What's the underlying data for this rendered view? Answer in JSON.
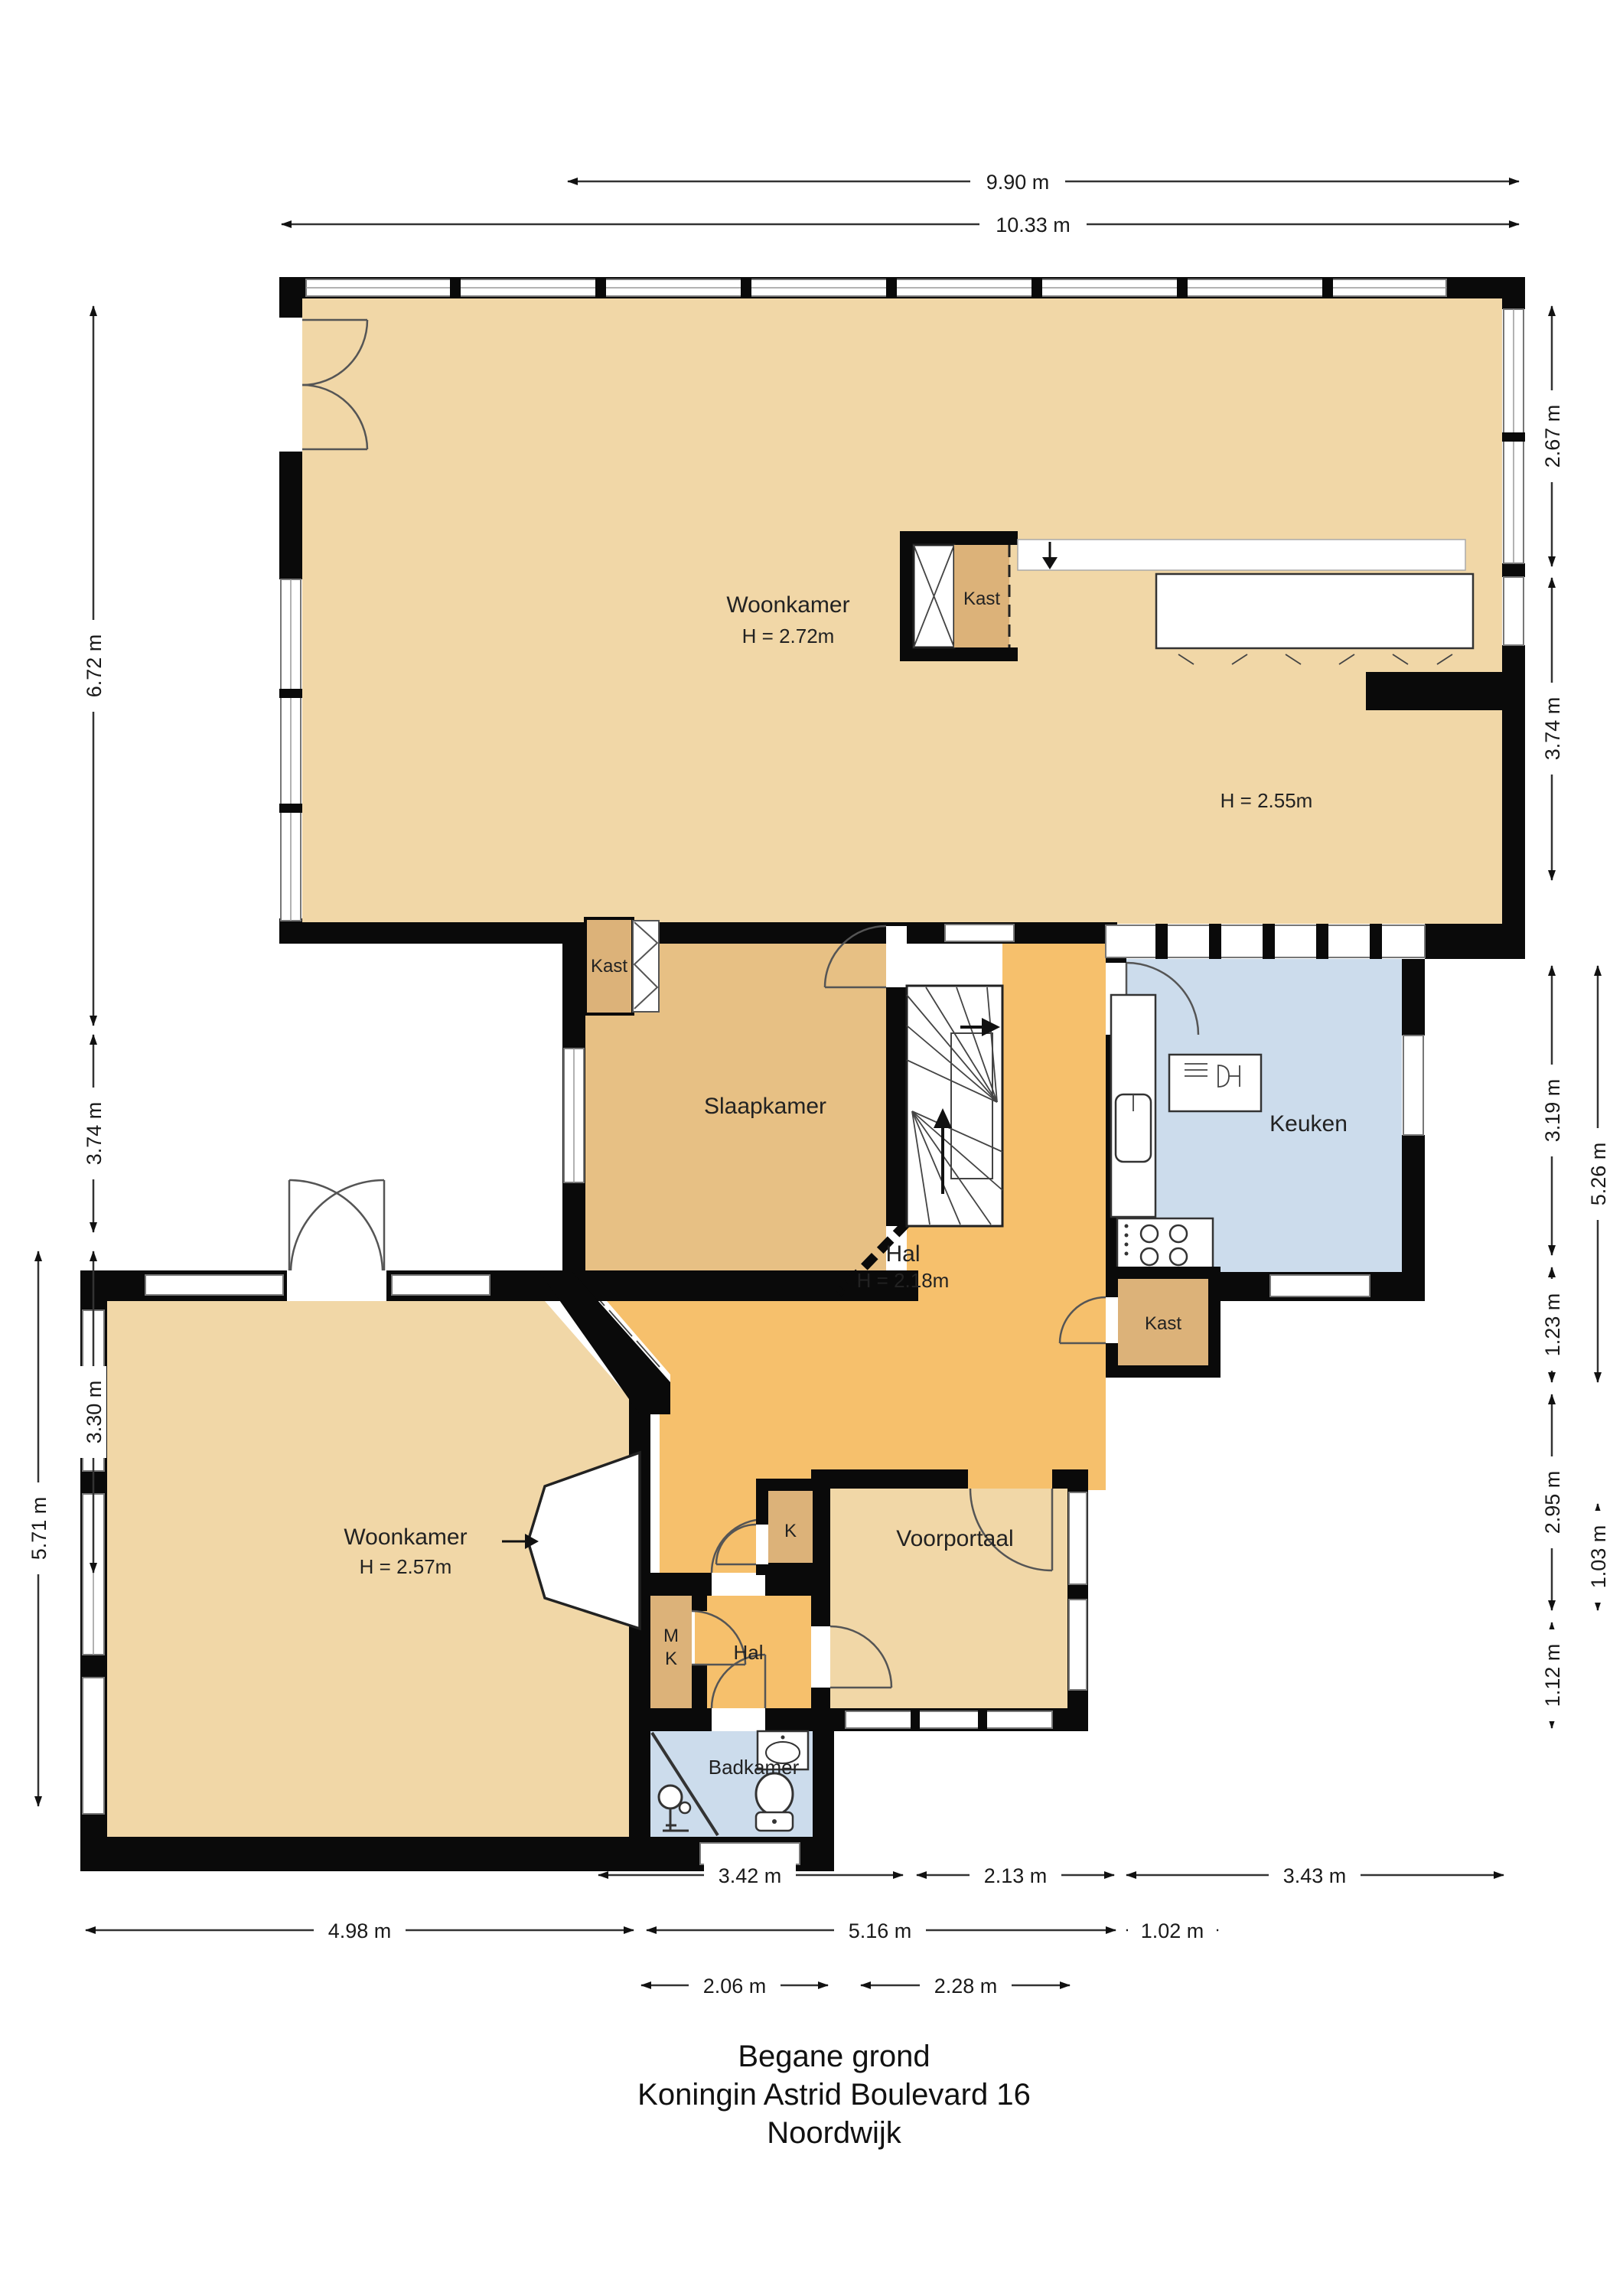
{
  "title": {
    "line1": "Begane grond",
    "line2": "Koningin Astrid Boulevard 16",
    "line3": "Noordwijk"
  },
  "rooms": {
    "woonkamer_boven": {
      "label": "Woonkamer",
      "height": "H = 2.72m"
    },
    "eethoek": {
      "height": "H = 2.55m"
    },
    "kast_boven": {
      "label": "Kast"
    },
    "slaapkamer": {
      "label": "Slaapkamer"
    },
    "kast_slaapkamer": {
      "label": "Kast"
    },
    "keuken": {
      "label": "Keuken"
    },
    "hal_groot": {
      "label": "Hal",
      "height": "H = 2.18m"
    },
    "kast_keuken": {
      "label": "Kast"
    },
    "woonkamer_beneden": {
      "label": "Woonkamer",
      "height": "H = 2.57m"
    },
    "k_kast": {
      "label": "K"
    },
    "meterkast": {
      "line1": "M",
      "line2": "K"
    },
    "voorportaal": {
      "label": "Voorportaal"
    },
    "hal_klein": {
      "label": "Hal"
    },
    "badkamer": {
      "label": "Badkamer"
    }
  },
  "dimensions": {
    "top": {
      "d1": "9.90 m",
      "d2": "10.33 m"
    },
    "left": {
      "d1": "6.72 m",
      "d2": "3.74 m",
      "d3": "3.30 m",
      "d4": "5.71 m"
    },
    "right": {
      "d1": "2.67 m",
      "d2": "3.74 m",
      "d3": "3.19 m",
      "d4": "1.23 m",
      "d5": "2.95 m",
      "d6": "1.12 m",
      "d7": "5.26 m",
      "d8": "1.03 m"
    },
    "bottom": {
      "d1": "3.42 m",
      "d2": "2.13 m",
      "d3": "3.43 m",
      "d4": "4.98 m",
      "d5": "5.16 m",
      "d6": "1.02 m",
      "d7": "2.06 m",
      "d8": "2.28 m"
    }
  },
  "colors": {
    "wall": "#0a0a0a",
    "living_tan": "#f1d7a7",
    "bedroom_tan": "#e7c084",
    "closet_brown": "#dcb279",
    "hall_orange": "#f6c06c",
    "wet_blue": "#ccdcec",
    "dimension_text": "#1a1a1a"
  }
}
